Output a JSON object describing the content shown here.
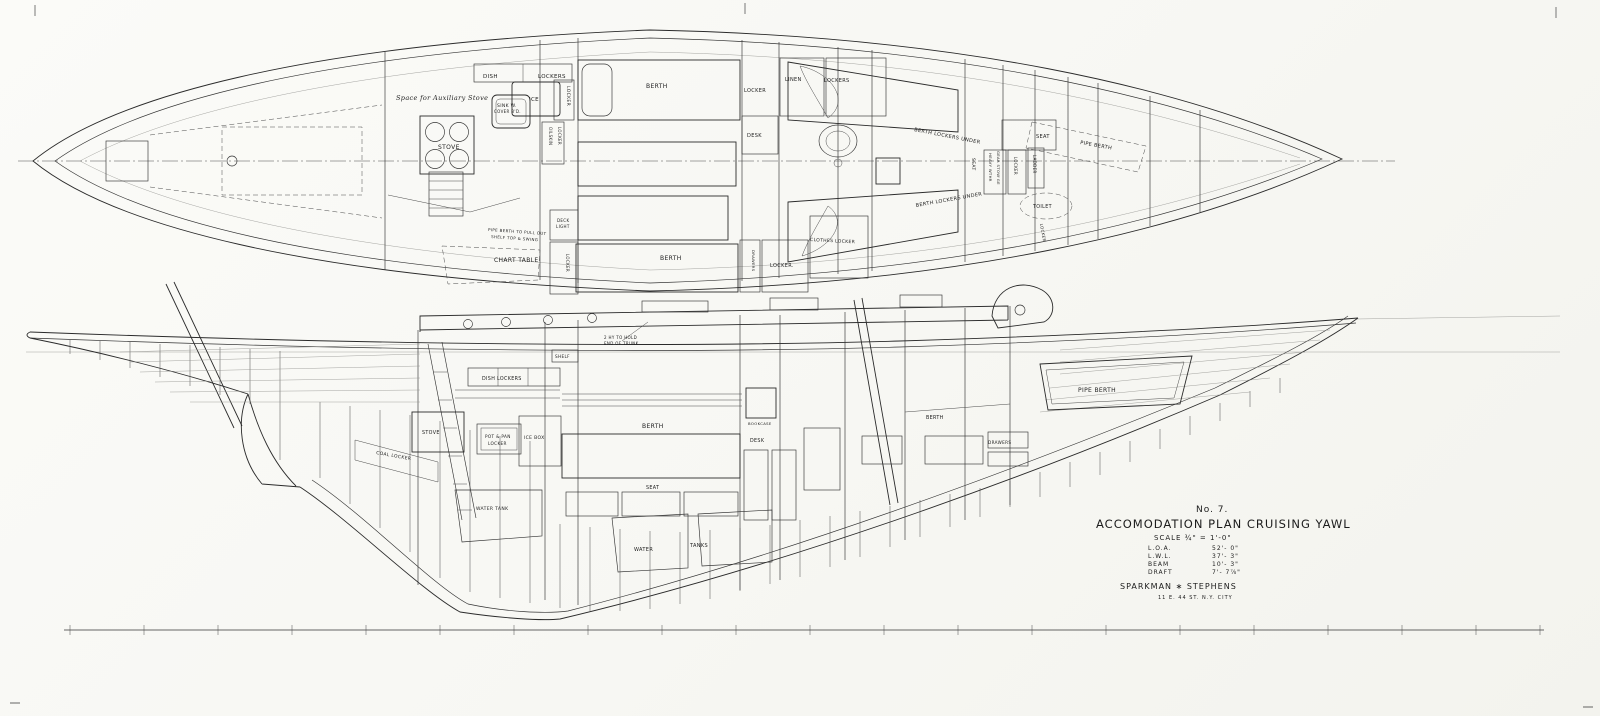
{
  "title_block": {
    "number": "No. 7.",
    "title": "ACCOMODATION PLAN CRUISING YAWL",
    "scale": "SCALE ¾\" = 1'-0\"",
    "specs": [
      {
        "label": "L.O.A.",
        "value": "52'- 0\""
      },
      {
        "label": "L.W.L.",
        "value": "37'- 3\""
      },
      {
        "label": "BEAM",
        "value": "10'- 3\""
      },
      {
        "label": "DRAFT",
        "value": "7'- 7⅞\""
      }
    ],
    "firm": "SPARKMAN ∗ STEPHENS",
    "address": "11 E. 44 ST. N.Y. CITY"
  },
  "plan": {
    "labels": [
      {
        "text": "DISH"
      },
      {
        "text": "LOCKERS"
      },
      {
        "text": "Space for Auxiliary Stove"
      },
      {
        "text": "SINK W."
      },
      {
        "text": "COVER B'D."
      },
      {
        "text": "ICE"
      },
      {
        "text": "STOVE"
      },
      {
        "text": "LOCKER"
      },
      {
        "text": "OILSKIN"
      },
      {
        "text": "LOCKER"
      },
      {
        "text": "BERTH"
      },
      {
        "text": "LOCKER"
      },
      {
        "text": "DESK"
      },
      {
        "text": "LINEN"
      },
      {
        "text": "LOCKERS"
      },
      {
        "text": "BERTH LOCKERS UNDER"
      },
      {
        "text": "SEAT"
      },
      {
        "text": "PIPE BERTH"
      },
      {
        "text": "SEAT"
      },
      {
        "text": "HEAVY WTHR"
      },
      {
        "text": "GEAR STOW'GE"
      },
      {
        "text": "LOCKER"
      },
      {
        "text": "LADDER"
      },
      {
        "text": "TOILET"
      },
      {
        "text": "BERTH LOCKERS UNDER"
      },
      {
        "text": "CHART TABLE"
      },
      {
        "text": "PIPE BERTH TO PULL OUT"
      },
      {
        "text": "SHELF TOP & SWING"
      },
      {
        "text": "DECK"
      },
      {
        "text": "LIGHT"
      },
      {
        "text": "LOCKER"
      },
      {
        "text": "BERTH"
      },
      {
        "text": "DRAWERS"
      },
      {
        "text": "LOCKER."
      },
      {
        "text": "CLOTHES LOCKER"
      },
      {
        "text": "LOCKER"
      }
    ]
  },
  "profile": {
    "labels": [
      {
        "text": "SHELF"
      },
      {
        "text": "2 HY TO HOLD"
      },
      {
        "text": "END OF TRUNK."
      },
      {
        "text": "DISH LOCKERS"
      },
      {
        "text": "STOVE"
      },
      {
        "text": "COAL LOCKER"
      },
      {
        "text": "POT & PAN"
      },
      {
        "text": "LOCKER"
      },
      {
        "text": "ICE BOX"
      },
      {
        "text": "WATER TANK"
      },
      {
        "text": "BERTH"
      },
      {
        "text": "SEAT"
      },
      {
        "text": "BOOKCASE"
      },
      {
        "text": "DESK"
      },
      {
        "text": "BERTH"
      },
      {
        "text": "DRAWERS"
      },
      {
        "text": "PIPE BERTH"
      },
      {
        "text": "WATER"
      },
      {
        "text": "TANKS"
      }
    ]
  }
}
